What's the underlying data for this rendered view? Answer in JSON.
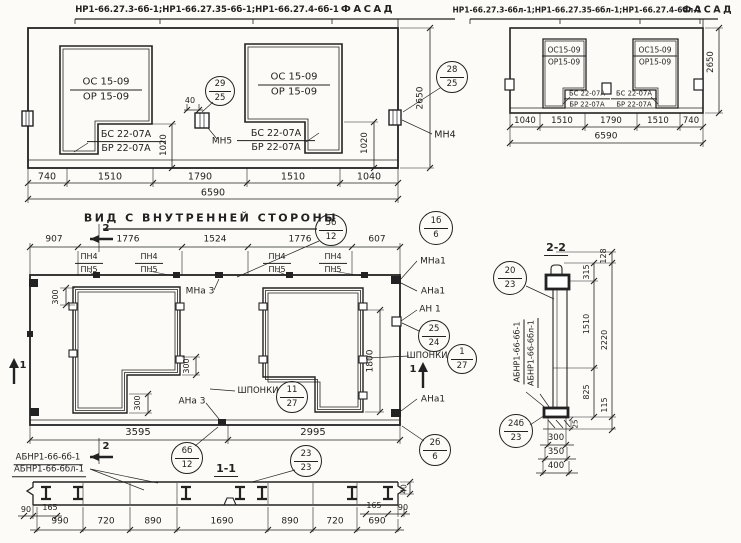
{
  "palette": {
    "paper": "#fcfbf7",
    "ink": "#222222"
  },
  "drawings": [
    {
      "id": "facade-left",
      "labels": [
        {
          "n": "drawing-title-marks",
          "t": "НР1-66.27.3-6б-1;НР1-66.27.35-6б-1;НР1-66.27.4-6б-1",
          "x": 207,
          "y": 10,
          "fs": 8.5,
          "b": 1
        },
        {
          "n": "drawing-title-view",
          "t": "ФАСАД",
          "x": 368,
          "y": 10,
          "fs": 10,
          "b": 1,
          "ls": 1
        },
        {
          "n": "dim-label",
          "t": "740",
          "x": 47,
          "y": 177,
          "fs": 9.5
        },
        {
          "n": "dim-label",
          "t": "1510",
          "x": 110,
          "y": 177,
          "fs": 9.5
        },
        {
          "n": "dim-label",
          "t": "1790",
          "x": 200,
          "y": 177,
          "fs": 9.5
        },
        {
          "n": "dim-label",
          "t": "1510",
          "x": 293,
          "y": 177,
          "fs": 9.5
        },
        {
          "n": "dim-label",
          "t": "1040",
          "x": 369,
          "y": 177,
          "fs": 9.5
        },
        {
          "n": "dim-label-total",
          "t": "6590",
          "x": 213,
          "y": 193,
          "fs": 9.5
        },
        {
          "n": "dim-label-height",
          "t": "2650",
          "x": 421,
          "y": 98,
          "fs": 9,
          "rot": 1
        },
        {
          "n": "dim-label",
          "t": "1020",
          "x": 164,
          "y": 145,
          "fs": 8.5,
          "rot": 1
        },
        {
          "n": "dim-label",
          "t": "1020",
          "x": 365,
          "y": 143,
          "fs": 8.5,
          "rot": 1
        },
        {
          "n": "dim-label",
          "t": "40",
          "x": 190,
          "y": 101,
          "fs": 8
        },
        {
          "n": "anchor-label",
          "t": "МН5",
          "x": 222,
          "y": 142,
          "fs": 9
        },
        {
          "n": "anchor-label",
          "t": "МН4",
          "x": 445,
          "y": 135,
          "fs": 9.5
        }
      ],
      "fracs": [
        {
          "n": "window-mark",
          "l1": "ОС 15-09",
          "l2": "ОР 15-09",
          "x": 106,
          "y": 90,
          "w": 72,
          "fs": 10
        },
        {
          "n": "window-mark",
          "l1": "ОС 15-09",
          "l2": "ОР 15-09",
          "x": 294,
          "y": 85,
          "w": 72,
          "fs": 10
        },
        {
          "n": "lintel-mark",
          "l1": "БС 22-07А",
          "l2": "БР 22-07А",
          "x": 126,
          "y": 142,
          "w": 78,
          "fs": 9.5
        },
        {
          "n": "lintel-mark",
          "l1": "БС 22-07А",
          "l2": "БР 22-07А",
          "x": 276,
          "y": 141,
          "w": 78,
          "fs": 9.5
        }
      ],
      "circles": [
        {
          "n": "detail-bubble",
          "top": "29",
          "bot": "25",
          "x": 220,
          "y": 91,
          "r": 15
        },
        {
          "n": "detail-bubble",
          "top": "28",
          "bot": "25",
          "x": 452,
          "y": 77,
          "r": 16
        }
      ]
    },
    {
      "id": "facade-right",
      "labels": [
        {
          "n": "drawing-title-marks",
          "t": "НР1-66.27.3-6бл-1;НР1-66.27.35-6бл-1;НР1-66.27.4-6бл-1",
          "x": 577,
          "y": 10,
          "fs": 7.5,
          "b": 1
        },
        {
          "n": "drawing-title-view",
          "t": "ФАСАД",
          "x": 708,
          "y": 10,
          "fs": 9.5,
          "b": 1,
          "ls": 1
        },
        {
          "n": "dim-label",
          "t": "1040",
          "x": 525,
          "y": 121,
          "fs": 8.5
        },
        {
          "n": "dim-label",
          "t": "1510",
          "x": 562,
          "y": 121,
          "fs": 8.5
        },
        {
          "n": "dim-label",
          "t": "1790",
          "x": 611,
          "y": 121,
          "fs": 8.5
        },
        {
          "n": "dim-label",
          "t": "1510",
          "x": 658,
          "y": 121,
          "fs": 8.5
        },
        {
          "n": "dim-label",
          "t": "740",
          "x": 691,
          "y": 121,
          "fs": 8.5
        },
        {
          "n": "dim-label-total",
          "t": "6590",
          "x": 606,
          "y": 137,
          "fs": 9
        },
        {
          "n": "dim-label-height",
          "t": "2650",
          "x": 711,
          "y": 62,
          "fs": 8.5,
          "rot": 1
        }
      ],
      "fracs": [
        {
          "n": "window-mark",
          "l1": "ОС15-09",
          "l2": "ОР15-09",
          "x": 564,
          "y": 56,
          "w": 44,
          "fs": 7.5
        },
        {
          "n": "window-mark",
          "l1": "ОС15-09",
          "l2": "ОР15-09",
          "x": 655,
          "y": 56,
          "w": 44,
          "fs": 7.5
        },
        {
          "n": "lintel-mark",
          "l1": "БС 22-07А",
          "l2": "БР 22-07А",
          "x": 587,
          "y": 99,
          "w": 46,
          "fs": 6.8
        },
        {
          "n": "lintel-mark",
          "l1": "БС 22-07А",
          "l2": "БР 22-07А",
          "x": 634,
          "y": 99,
          "w": 46,
          "fs": 6.8
        }
      ],
      "circles": []
    },
    {
      "id": "inner-view",
      "labels": [
        {
          "n": "view-title",
          "t": "ВИД С ВНУТРЕННЕЙ СТОРОНЫ",
          "x": 211,
          "y": 218,
          "fs": 11,
          "b": 1,
          "ls": 1
        },
        {
          "n": "dim-label",
          "t": "907",
          "x": 54,
          "y": 240,
          "fs": 9
        },
        {
          "n": "dim-label",
          "t": "1776",
          "x": 128,
          "y": 240,
          "fs": 9
        },
        {
          "n": "dim-label",
          "t": "1524",
          "x": 215,
          "y": 240,
          "fs": 9
        },
        {
          "n": "dim-label",
          "t": "1776",
          "x": 300,
          "y": 240,
          "fs": 9
        },
        {
          "n": "dim-label",
          "t": "607",
          "x": 377,
          "y": 240,
          "fs": 9
        },
        {
          "n": "section-marker-label",
          "t": "2",
          "x": 106,
          "y": 229,
          "fs": 10,
          "b": 1
        },
        {
          "n": "section-marker-label",
          "t": "2",
          "x": 106,
          "y": 447,
          "fs": 10,
          "b": 1
        },
        {
          "n": "anchor-label",
          "t": "МНа 3",
          "x": 200,
          "y": 292,
          "fs": 9
        },
        {
          "n": "anchor-label",
          "t": "АНа 3",
          "x": 192,
          "y": 402,
          "fs": 9
        },
        {
          "n": "keys-label",
          "t": "ШПОНКИ",
          "x": 258,
          "y": 391,
          "fs": 8.5
        },
        {
          "n": "anchor-label",
          "t": "МНа1",
          "x": 433,
          "y": 262,
          "fs": 9
        },
        {
          "n": "anchor-label",
          "t": "АНа1",
          "x": 433,
          "y": 292,
          "fs": 9
        },
        {
          "n": "anchor-label",
          "t": "АН 1",
          "x": 430,
          "y": 310,
          "fs": 9
        },
        {
          "n": "keys-label",
          "t": "ШПОНКИ",
          "x": 427,
          "y": 356,
          "fs": 8.5
        },
        {
          "n": "anchor-label",
          "t": "АНа1",
          "x": 433,
          "y": 400,
          "fs": 9
        },
        {
          "n": "section-marker-label",
          "t": "1",
          "x": 413,
          "y": 370,
          "fs": 10,
          "b": 1
        },
        {
          "n": "section-marker-label",
          "t": "1",
          "x": 23,
          "y": 366,
          "fs": 10,
          "b": 1
        },
        {
          "n": "dim-label",
          "t": "300",
          "x": 56,
          "y": 297,
          "fs": 8,
          "rot": 1
        },
        {
          "n": "dim-label",
          "t": "300",
          "x": 187,
          "y": 366,
          "fs": 8,
          "rot": 1
        },
        {
          "n": "dim-label",
          "t": "300",
          "x": 138,
          "y": 403,
          "fs": 8,
          "rot": 1
        },
        {
          "n": "dim-label",
          "t": "1800",
          "x": 371,
          "y": 361,
          "fs": 9,
          "rot": 1
        },
        {
          "n": "dim-label",
          "t": "3595",
          "x": 138,
          "y": 433,
          "fs": 10
        },
        {
          "n": "dim-label",
          "t": "2995",
          "x": 313,
          "y": 433,
          "fs": 10
        }
      ],
      "fracs": [
        {
          "n": "joint-mark",
          "l1": "ПН4",
          "l2": "ПН5",
          "x": 89,
          "y": 263,
          "w": 28,
          "fs": 8
        },
        {
          "n": "joint-mark",
          "l1": "ПН4",
          "l2": "ПН5",
          "x": 149,
          "y": 263,
          "w": 28,
          "fs": 8
        },
        {
          "n": "joint-mark",
          "l1": "ПН4",
          "l2": "ПН5",
          "x": 277,
          "y": 263,
          "w": 28,
          "fs": 8
        },
        {
          "n": "joint-mark",
          "l1": "ПН4",
          "l2": "ПН5",
          "x": 333,
          "y": 263,
          "w": 28,
          "fs": 8
        }
      ],
      "circles": [
        {
          "n": "detail-bubble",
          "top": "5б",
          "bot": "12",
          "x": 331,
          "y": 230,
          "r": 16
        },
        {
          "n": "detail-bubble",
          "top": "1б",
          "bot": "6",
          "x": 436,
          "y": 228,
          "r": 17
        },
        {
          "n": "detail-bubble",
          "top": "25",
          "bot": "24",
          "x": 434,
          "y": 336,
          "r": 16
        },
        {
          "n": "detail-bubble",
          "top": "1",
          "bot": "27",
          "x": 462,
          "y": 359,
          "r": 15
        },
        {
          "n": "detail-bubble",
          "top": "11",
          "bot": "27",
          "x": 292,
          "y": 397,
          "r": 16
        },
        {
          "n": "detail-bubble",
          "top": "6б",
          "bot": "12",
          "x": 187,
          "y": 458,
          "r": 16
        },
        {
          "n": "detail-bubble",
          "top": "2б",
          "bot": "6",
          "x": 435,
          "y": 450,
          "r": 16
        }
      ]
    },
    {
      "id": "section-1-1",
      "labels": [
        {
          "n": "panel-mark",
          "t": "АБНР1-66-6б-1",
          "x": 48,
          "y": 459,
          "fs": 8.5,
          "u": 1
        },
        {
          "n": "panel-mark",
          "t": "АБНР1-66-6бл-1",
          "x": 49,
          "y": 471,
          "fs": 8.5,
          "u": 1
        },
        {
          "n": "section-title",
          "t": "1-1",
          "x": 226,
          "y": 470,
          "fs": 11,
          "b": 1,
          "u": 1
        },
        {
          "n": "dim-label",
          "t": "990",
          "x": 60,
          "y": 522,
          "fs": 9
        },
        {
          "n": "dim-label",
          "t": "720",
          "x": 106,
          "y": 522,
          "fs": 9
        },
        {
          "n": "dim-label",
          "t": "890",
          "x": 153,
          "y": 522,
          "fs": 9
        },
        {
          "n": "dim-label",
          "t": "1690",
          "x": 222,
          "y": 522,
          "fs": 9
        },
        {
          "n": "dim-label",
          "t": "890",
          "x": 290,
          "y": 522,
          "fs": 9
        },
        {
          "n": "dim-label",
          "t": "720",
          "x": 335,
          "y": 522,
          "fs": 9
        },
        {
          "n": "dim-label",
          "t": "690",
          "x": 377,
          "y": 522,
          "fs": 9
        },
        {
          "n": "dim-label",
          "t": "90",
          "x": 26,
          "y": 510,
          "fs": 8
        },
        {
          "n": "dim-label",
          "t": "165",
          "x": 50,
          "y": 508,
          "fs": 8
        },
        {
          "n": "dim-label",
          "t": "165",
          "x": 374,
          "y": 506,
          "fs": 8
        },
        {
          "n": "dim-label",
          "t": "90",
          "x": 403,
          "y": 508,
          "fs": 8
        },
        {
          "n": "dim-label",
          "t": "40",
          "x": 404,
          "y": 489,
          "fs": 7.5,
          "rot": 1
        }
      ],
      "fracs": [],
      "circles": [
        {
          "n": "detail-bubble",
          "top": "23",
          "bot": "23",
          "x": 306,
          "y": 461,
          "r": 16
        }
      ]
    },
    {
      "id": "section-2-2",
      "labels": [
        {
          "n": "section-title",
          "t": "2-2",
          "x": 556,
          "y": 249,
          "fs": 11,
          "b": 1,
          "u": 1
        },
        {
          "n": "dim-label",
          "t": "128",
          "x": 604,
          "y": 256,
          "fs": 8,
          "rot": 1
        },
        {
          "n": "dim-label",
          "t": "315",
          "x": 587,
          "y": 272,
          "fs": 8,
          "rot": 1
        },
        {
          "n": "dim-label",
          "t": "1510",
          "x": 587,
          "y": 324,
          "fs": 8,
          "rot": 1
        },
        {
          "n": "dim-label",
          "t": "2220",
          "x": 605,
          "y": 340,
          "fs": 8,
          "rot": 1
        },
        {
          "n": "dim-label",
          "t": "825",
          "x": 587,
          "y": 392,
          "fs": 8,
          "rot": 1
        },
        {
          "n": "dim-label",
          "t": "115",
          "x": 605,
          "y": 405,
          "fs": 8,
          "rot": 1
        },
        {
          "n": "dim-label",
          "t": "25",
          "x": 576,
          "y": 424,
          "fs": 7,
          "rot": 1
        },
        {
          "n": "dim-label",
          "t": "300",
          "x": 556,
          "y": 438,
          "fs": 8.5
        },
        {
          "n": "dim-label",
          "t": "350",
          "x": 556,
          "y": 452,
          "fs": 8.5
        },
        {
          "n": "dim-label",
          "t": "400",
          "x": 556,
          "y": 466,
          "fs": 8.5
        },
        {
          "n": "panel-mark",
          "t": "АБНР1-66-6б-1",
          "x": 519,
          "y": 352,
          "fs": 8,
          "rot": 1,
          "u": 1
        },
        {
          "n": "panel-mark",
          "t": "АБНР1-66-6бл-1",
          "x": 533,
          "y": 353,
          "fs": 8,
          "rot": 1,
          "u": 1
        }
      ],
      "fracs": [],
      "circles": [
        {
          "n": "detail-bubble",
          "top": "20",
          "bot": "23",
          "x": 510,
          "y": 278,
          "r": 17
        },
        {
          "n": "detail-bubble",
          "top": "24б",
          "bot": "23",
          "x": 516,
          "y": 431,
          "r": 17
        }
      ]
    }
  ]
}
